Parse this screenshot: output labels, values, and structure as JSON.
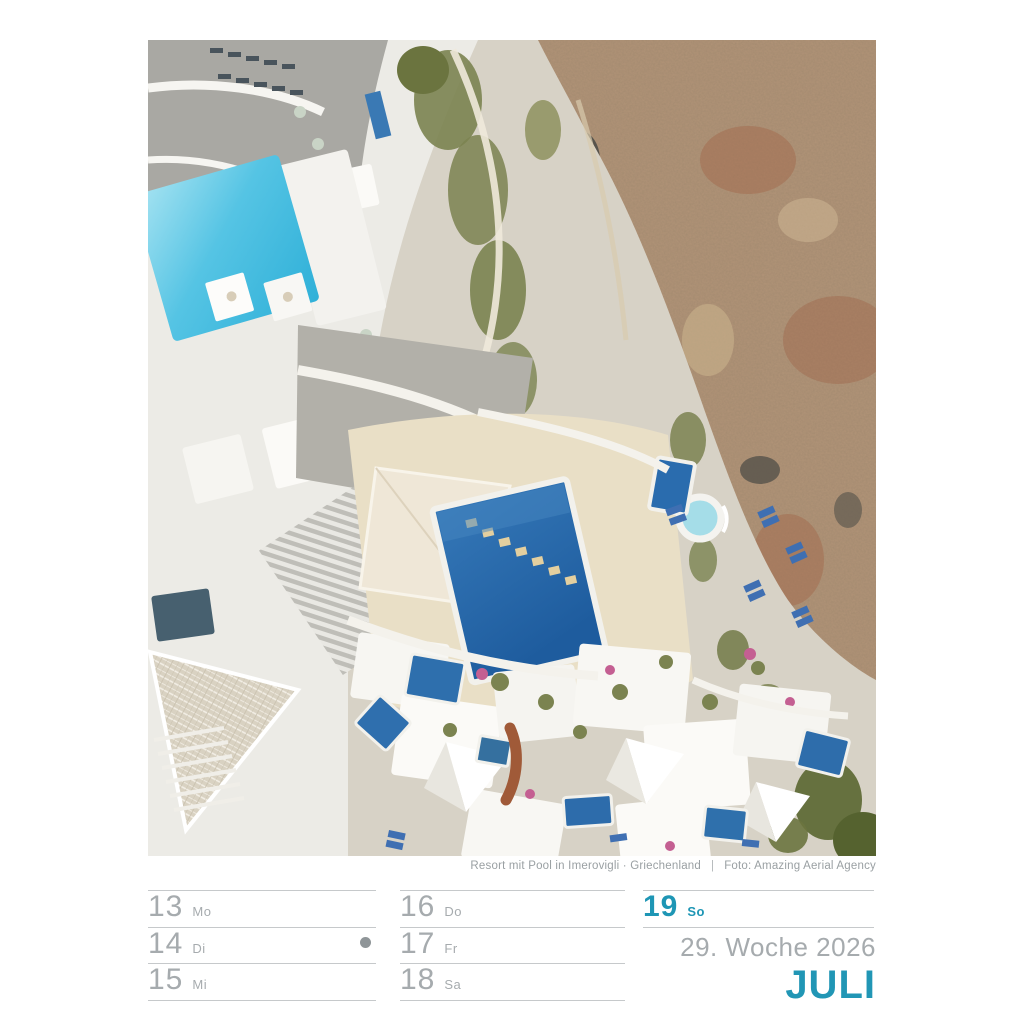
{
  "photo": {
    "caption": {
      "title": "Resort mit Pool in Imerovigli · Griechenland",
      "divider": "|",
      "credit": "Foto: Amazing Aerial Agency"
    }
  },
  "calendar": {
    "columns": [
      {
        "days": [
          {
            "date": "13",
            "weekday": "Mo"
          },
          {
            "date": "14",
            "weekday": "Di"
          },
          {
            "date": "15",
            "weekday": "Mi"
          }
        ]
      },
      {
        "days": [
          {
            "date": "16",
            "weekday": "Do"
          },
          {
            "date": "17",
            "weekday": "Fr"
          },
          {
            "date": "18",
            "weekday": "Sa"
          }
        ]
      },
      {
        "days": [
          {
            "date": "19",
            "weekday": "So"
          }
        ]
      }
    ],
    "moon_phase": {
      "day": "14",
      "type": "new-moon"
    },
    "week_label": "29. Woche 2026",
    "month_label": "JULI"
  },
  "colors": {
    "accent_teal": "#2196b5",
    "text_gray": "#a6abae",
    "line_gray": "#c6c9cb",
    "pool_light": "#55c4e4",
    "pool_deep": "#2a6cab",
    "hill_brown": "#b29478"
  }
}
